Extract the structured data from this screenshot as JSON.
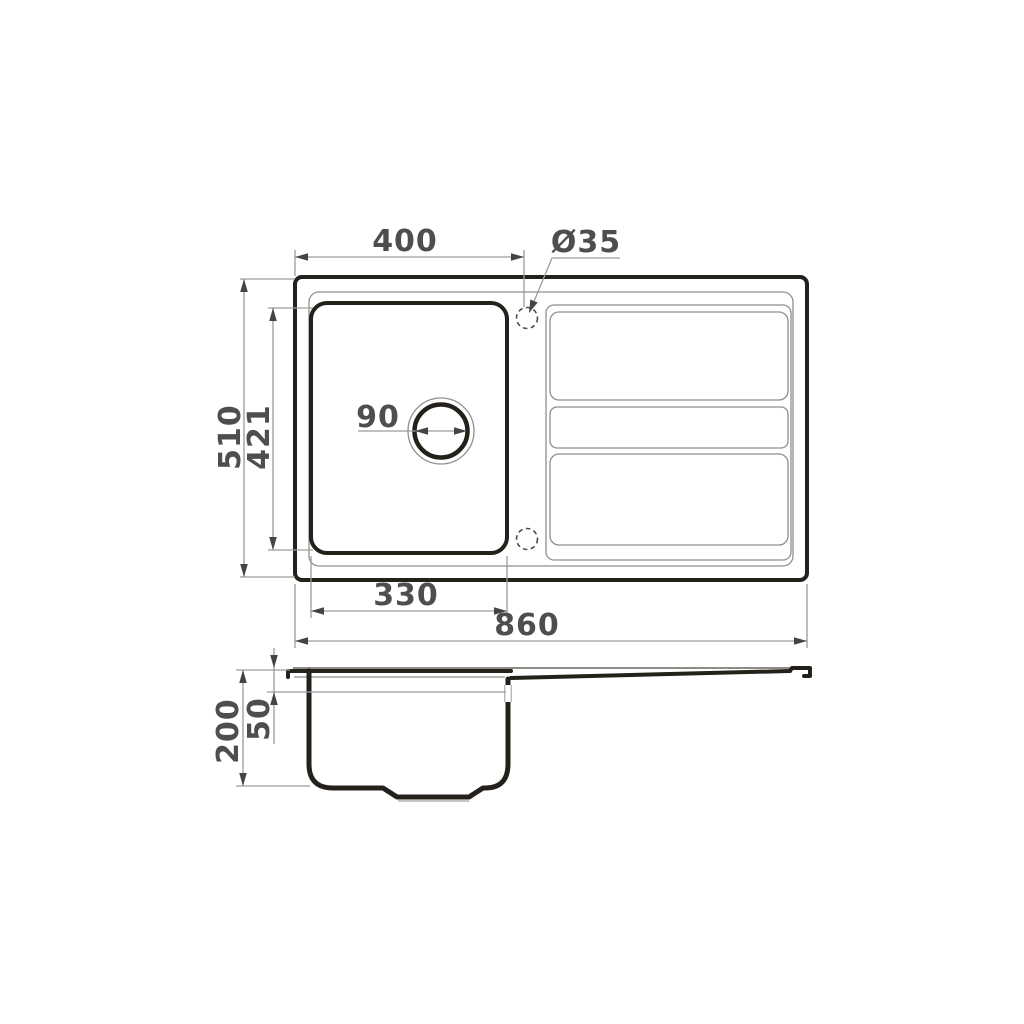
{
  "page": {
    "background": "#ffffff",
    "description": "Technical dimension drawing of a kitchen sink with one bowl and a grooved drainboard: top (plan) view and side section view"
  },
  "units": "mm",
  "colors": {
    "outline": "#24211b",
    "thin_line": "#8f8f8f",
    "dimension_line": "#9c9c9c",
    "arrow": "#444444",
    "text": "#4e4e4e",
    "background": "#ffffff"
  },
  "top_view": {
    "dimensions": {
      "edge_to_tap_hole": "400",
      "tap_hole_diameter": "Ø35",
      "overall_depth": "510",
      "bowl_depth": "421",
      "drain_diameter": "90",
      "bowl_width": "330",
      "overall_width": "860"
    },
    "features": [
      "bowl",
      "drain-hole",
      "tap-hole-top",
      "tap-hole-bottom",
      "drainboard-grooves"
    ]
  },
  "side_view": {
    "dimensions": {
      "overall_height": "200",
      "rim_to_overflow": "50"
    },
    "features": [
      "bowl-section",
      "drain-recess",
      "overflow-notch",
      "sloped-drainboard"
    ]
  }
}
